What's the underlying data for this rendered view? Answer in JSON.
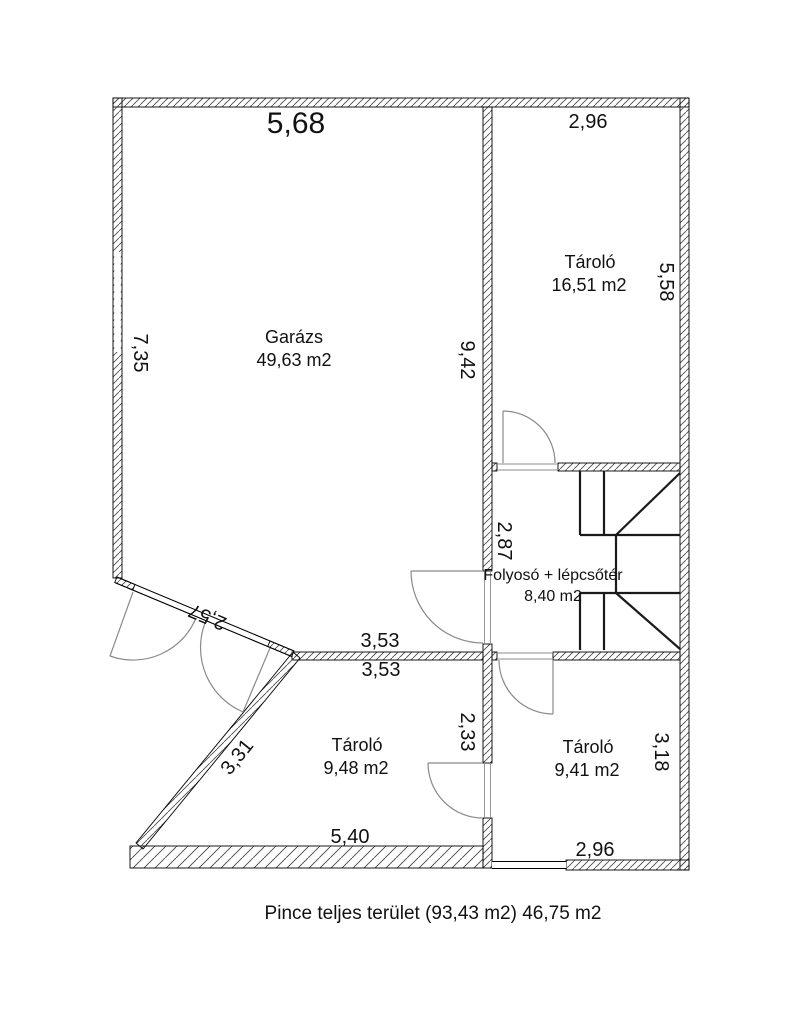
{
  "plan": {
    "caption": "Pince teljes terület (93,43 m2) 46,75 m2",
    "rooms": {
      "garage": {
        "name": "Garázs",
        "area": "49,63 m2"
      },
      "storage_tr": {
        "name": "Tároló",
        "area": "16,51 m2"
      },
      "hall": {
        "name": "Folyosó + lépcsőtér",
        "area": "8,40 m2"
      },
      "storage_bl": {
        "name": "Tároló",
        "area": "9,48 m2"
      },
      "storage_br": {
        "name": "Tároló",
        "area": "9,41 m2"
      }
    },
    "dims": {
      "garage_top": "5,68",
      "storage_tr_top": "2,96",
      "garage_left": "7,35",
      "garage_right": "9,42",
      "storage_tr_right": "5,58",
      "hall_left": "2,87",
      "garage_diag": "2,57",
      "garage_bottom": "3,53",
      "storage_bl_top": "3,53",
      "storage_bl_diag": "3,31",
      "storage_bl_right": "2,33",
      "storage_br_right": "3,18",
      "storage_bl_bottom": "5,40",
      "storage_br_bottom": "2,96"
    },
    "colors": {
      "wall_outline": "#000000",
      "hatch": "#444444",
      "door": "#8a8a8a",
      "stairs": "#1a1a1a",
      "text": "#111111",
      "background": "#ffffff"
    }
  }
}
